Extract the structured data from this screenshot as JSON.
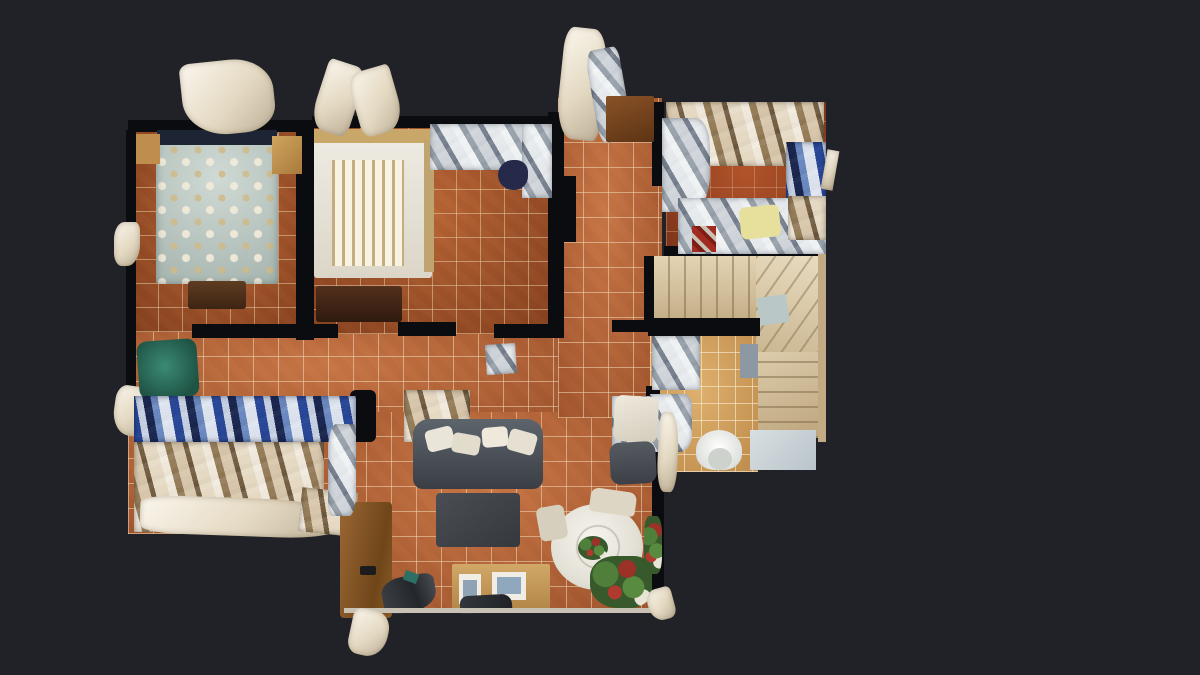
{
  "app": {
    "name": "3d-dollhouse-floorplan-viewer",
    "view_mode": "top-down dollhouse view",
    "content": "furnished apartment photogrammetry scan with scan-glitch artifacts"
  },
  "canvas": {
    "width": 1200,
    "height": 675,
    "background": "#212227"
  },
  "palette": {
    "background": "#212227",
    "wall": "#0b0c0f",
    "tile_terracotta": "#b46238",
    "tile_bedroom": "#a2542b",
    "tile_junk_room": "#9c4423",
    "tile_bathroom": "#d09d58",
    "stairs_beige": "#d7c39c",
    "sofa_gray": "#4c5157",
    "bed_floral": "#c3cfc9",
    "bed_white": "#e9e5da",
    "armchair_green": "#2c6f60",
    "dining_table_white": "#efede5",
    "wood": "#9a6633",
    "artifact_white": "#fbf7ee"
  },
  "scene": {
    "objects": [
      {
        "name": "floor-hallway",
        "cls": "tile",
        "x": 128,
        "y": 330,
        "w": 434,
        "h": 102
      },
      {
        "name": "floor-storage-corridor",
        "cls": "tile",
        "x": 128,
        "y": 420,
        "w": 220,
        "h": 114
      },
      {
        "name": "floor-living-room",
        "cls": "tile",
        "x": 341,
        "y": 412,
        "w": 320,
        "h": 200
      },
      {
        "name": "floor-corridor-top",
        "cls": "tile",
        "x": 558,
        "y": 98,
        "w": 104,
        "h": 320
      },
      {
        "name": "floor-bedroom-1",
        "cls": "tile-dark",
        "x": 134,
        "y": 130,
        "w": 176,
        "h": 202
      },
      {
        "name": "floor-bedroom-2",
        "cls": "tile-dark",
        "x": 312,
        "y": 126,
        "w": 240,
        "h": 208
      },
      {
        "name": "floor-junk-room",
        "cls": "tile-red",
        "x": 666,
        "y": 102,
        "w": 160,
        "h": 152
      },
      {
        "name": "floor-bathroom",
        "cls": "tile-light",
        "x": 650,
        "y": 334,
        "w": 108,
        "h": 138
      },
      {
        "name": "stairs-upper-flight",
        "cls": "steps-v",
        "x": 652,
        "y": 256,
        "w": 110,
        "h": 64
      },
      {
        "name": "stairs-winder",
        "cls": "steps-diag",
        "x": 756,
        "y": 256,
        "w": 66,
        "h": 104
      },
      {
        "name": "stairs-blue-patch",
        "x": 758,
        "y": 296,
        "w": 30,
        "h": 28,
        "bg": "#b9c8c6",
        "rot": -8
      },
      {
        "name": "stairs-lower-flight",
        "cls": "steps-h",
        "x": 758,
        "y": 352,
        "w": 64,
        "h": 86
      },
      {
        "name": "stairs-landing",
        "x": 750,
        "y": 430,
        "w": 66,
        "h": 40,
        "bg": "linear-gradient(135deg,#d8dfe2,#b9c4ca)"
      },
      {
        "name": "wall-bedroom1-left",
        "cls": "wall",
        "x": 126,
        "y": 130,
        "w": 10,
        "h": 294
      },
      {
        "name": "wall-bedroom1-top",
        "cls": "wall",
        "x": 128,
        "y": 120,
        "w": 184,
        "h": 12
      },
      {
        "name": "wall-bedroom-divider",
        "cls": "wall",
        "x": 296,
        "y": 126,
        "w": 18,
        "h": 214
      },
      {
        "name": "wall-bedroom2-top",
        "cls": "wall",
        "x": 312,
        "y": 116,
        "w": 240,
        "h": 12
      },
      {
        "name": "wall-bedroom2-right",
        "cls": "wall",
        "x": 548,
        "y": 112,
        "w": 16,
        "h": 222
      },
      {
        "name": "wall-hall-top-a",
        "cls": "wall",
        "x": 192,
        "y": 324,
        "w": 146,
        "h": 14
      },
      {
        "name": "wall-hall-top-b",
        "cls": "wall",
        "x": 398,
        "y": 322,
        "w": 58,
        "h": 14
      },
      {
        "name": "wall-hall-top-c",
        "cls": "wall",
        "x": 494,
        "y": 324,
        "w": 70,
        "h": 14
      },
      {
        "name": "wall-hall-top-d",
        "cls": "wall",
        "x": 612,
        "y": 320,
        "w": 52,
        "h": 12
      },
      {
        "name": "wall-stairs-hall-divider",
        "cls": "wall",
        "x": 648,
        "y": 318,
        "w": 112,
        "h": 18
      },
      {
        "name": "wall-junkroom-left",
        "cls": "wall",
        "x": 652,
        "y": 102,
        "w": 12,
        "h": 84
      },
      {
        "name": "wall-junkroom-bottom",
        "cls": "wall",
        "x": 664,
        "y": 246,
        "w": 158,
        "h": 10
      },
      {
        "name": "wall-stairs-left",
        "cls": "wall",
        "x": 644,
        "y": 256,
        "w": 10,
        "h": 64
      },
      {
        "name": "wall-bathroom-left",
        "cls": "wall",
        "x": 646,
        "y": 386,
        "w": 14,
        "h": 88
      },
      {
        "name": "wall-livingroom-right",
        "cls": "wall",
        "x": 652,
        "y": 412,
        "w": 12,
        "h": 200
      },
      {
        "name": "wall-corridor-stub",
        "cls": "wall",
        "x": 558,
        "y": 176,
        "w": 18,
        "h": 66
      },
      {
        "name": "wall-storage-block",
        "cls": "wall",
        "x": 350,
        "y": 390,
        "w": 26,
        "h": 52,
        "br": "6px"
      },
      {
        "name": "bed-floral",
        "cls": "floral",
        "x": 156,
        "y": 132,
        "w": 122,
        "h": 152,
        "br": "3px"
      },
      {
        "name": "bed-floral-headboard",
        "x": 157,
        "y": 130,
        "w": 120,
        "h": 15,
        "bg": "#1d2434"
      },
      {
        "name": "bed-foot-bench",
        "x": 188,
        "y": 281,
        "w": 58,
        "h": 28,
        "bg": "linear-gradient(180deg,#5f3c22,#3c2414)",
        "br": "3px"
      },
      {
        "name": "nightstand-left",
        "x": 136,
        "y": 134,
        "w": 24,
        "h": 30,
        "bg": "#bf8e4c"
      },
      {
        "name": "nightstand-right",
        "x": 272,
        "y": 136,
        "w": 30,
        "h": 38,
        "bg": "linear-gradient(135deg,#d0a55e,#a87a3c)"
      },
      {
        "name": "scan-artifact-headboard",
        "cls": "glitch",
        "x": 182,
        "y": 60,
        "w": 92,
        "h": 74,
        "br": "12% 45% 35% 50%",
        "rot": -6
      },
      {
        "name": "scan-artifact-left-upper",
        "cls": "glitch",
        "x": 114,
        "y": 222,
        "w": 26,
        "h": 44,
        "br": "40% 20% 50% 30%"
      },
      {
        "name": "scan-artifact-left-lower",
        "cls": "glitch",
        "x": 114,
        "y": 386,
        "w": 36,
        "h": 50,
        "br": "30% 45% 25% 50%",
        "rot": 8
      },
      {
        "name": "bed-white",
        "x": 314,
        "y": 130,
        "w": 118,
        "h": 148,
        "bg": "linear-gradient(180deg,#efece4,#dcd6c8)",
        "br": "3px"
      },
      {
        "name": "bed-white-headboard",
        "x": 314,
        "y": 129,
        "w": 118,
        "h": 14,
        "bg": "#c8a768"
      },
      {
        "name": "bed-white-blanket",
        "cls": "slats",
        "x": 332,
        "y": 160,
        "w": 72,
        "h": 106
      },
      {
        "name": "bed-white-side-rail",
        "x": 424,
        "y": 140,
        "w": 10,
        "h": 132,
        "bg": "#c0a470"
      },
      {
        "name": "dresser-dark",
        "x": 316,
        "y": 286,
        "w": 86,
        "h": 36,
        "bg": "linear-gradient(180deg,#53301d,#2e1a0e)",
        "br": "3px"
      },
      {
        "name": "wardrobe-mirror-top",
        "cls": "clutter-cool",
        "x": 430,
        "y": 124,
        "w": 120,
        "h": 46
      },
      {
        "name": "wardrobe-mirror-right",
        "cls": "clutter-cool",
        "x": 522,
        "y": 124,
        "w": 30,
        "h": 74
      },
      {
        "name": "chair-navy",
        "x": 498,
        "y": 160,
        "w": 30,
        "h": 30,
        "bg": "#262a4a",
        "br": "50% 40% 45% 50%"
      },
      {
        "name": "door-artifact-1",
        "cls": "glitch",
        "x": 318,
        "y": 62,
        "w": 40,
        "h": 72,
        "rot": 18,
        "br": "10% 30% 20% 40%"
      },
      {
        "name": "door-artifact-2",
        "cls": "glitch",
        "x": 354,
        "y": 68,
        "w": 44,
        "h": 66,
        "rot": -16,
        "br": "30% 10% 45% 20%"
      },
      {
        "name": "door-artifact-3",
        "cls": "glitch",
        "x": 560,
        "y": 28,
        "w": 44,
        "h": 112,
        "rot": 6,
        "br": "20% 35% 15% 40%"
      },
      {
        "name": "door-artifact-4",
        "cls": "clutter-cool",
        "x": 592,
        "y": 48,
        "w": 34,
        "h": 94,
        "rot": -10,
        "br": "25% 15% 40% 20%"
      },
      {
        "name": "cabinet-wood",
        "x": 606,
        "y": 96,
        "w": 48,
        "h": 46,
        "bg": "linear-gradient(160deg,#8a5226,#5c3414)",
        "br": "2px"
      },
      {
        "name": "clutter-junk-top",
        "cls": "clutter-warm",
        "x": 666,
        "y": 102,
        "w": 158,
        "h": 64
      },
      {
        "name": "clutter-junk-left",
        "cls": "clutter-cool",
        "x": 662,
        "y": 118,
        "w": 48,
        "h": 94,
        "br": "0 30% 40% 0"
      },
      {
        "name": "clutter-junk-right-blue",
        "cls": "clutter-blue",
        "x": 786,
        "y": 142,
        "w": 40,
        "h": 90
      },
      {
        "name": "clutter-junk-bottom",
        "cls": "clutter-cool",
        "x": 678,
        "y": 198,
        "w": 148,
        "h": 56
      },
      {
        "name": "cushion-yellow",
        "x": 740,
        "y": 206,
        "w": 40,
        "h": 32,
        "bg": "#e6e09c",
        "br": "6px",
        "rot": -6
      },
      {
        "name": "clutter-junk-red",
        "x": 692,
        "y": 226,
        "w": 24,
        "h": 26,
        "bg": "repeating-linear-gradient(45deg,#a32c22 0 6px,#7c1e16 6px 10px,#c8c2b2 10px 14px)"
      },
      {
        "name": "clutter-junk-tan-corner",
        "cls": "clutter-warm",
        "x": 788,
        "y": 196,
        "w": 38,
        "h": 44
      },
      {
        "name": "glitch-junkroom-right",
        "cls": "glitch",
        "x": 824,
        "y": 150,
        "w": 12,
        "h": 40,
        "rot": 10
      },
      {
        "name": "bathroom-fixture-glitch",
        "cls": "clutter-cool",
        "x": 652,
        "y": 336,
        "w": 48,
        "h": 54
      },
      {
        "name": "sink-glitch",
        "cls": "clutter-cool",
        "x": 650,
        "y": 394,
        "w": 42,
        "h": 58,
        "br": "0 20% 30% 0"
      },
      {
        "name": "toilet-bowl",
        "x": 696,
        "y": 430,
        "w": 46,
        "h": 40,
        "bg": "radial-gradient(circle at 50% 45%,#ffffff,#dfe2de 70%,#c6cac4)",
        "br": "50% 50% 40% 40%"
      },
      {
        "name": "toilet-seat-opening",
        "x": 708,
        "y": 448,
        "w": 24,
        "h": 22,
        "bg": "#cdd2cc",
        "br": "50%"
      },
      {
        "name": "mat-blue-gray",
        "x": 740,
        "y": 344,
        "w": 18,
        "h": 34,
        "bg": "#8d99a2"
      },
      {
        "name": "mat-reflective",
        "cls": "clutter-cool",
        "x": 486,
        "y": 344,
        "w": 30,
        "h": 30,
        "rot": -4
      },
      {
        "name": "clutter-hall-right",
        "cls": "clutter-cool",
        "x": 612,
        "y": 396,
        "w": 38,
        "h": 78
      },
      {
        "name": "armchair-green",
        "x": 138,
        "y": 340,
        "w": 60,
        "h": 58,
        "bg": "radial-gradient(circle at 45% 45%,#3b8a74,#1f5445 75%)",
        "br": "10px",
        "rot": -4
      },
      {
        "name": "shelf-blue-bins",
        "cls": "clutter-blue",
        "x": 134,
        "y": 396,
        "w": 222,
        "h": 46
      },
      {
        "name": "clutter-bags-right",
        "cls": "clutter-warm",
        "x": 404,
        "y": 390,
        "w": 66,
        "h": 52
      },
      {
        "name": "shelf-lower-clutter",
        "cls": "clutter-warm",
        "x": 134,
        "y": 442,
        "w": 190,
        "h": 90
      },
      {
        "name": "glitch-storage-bottom",
        "cls": "glitch",
        "x": 140,
        "y": 498,
        "w": 200,
        "h": 38,
        "br": "20% 40% 30% 20%",
        "rot": 2
      },
      {
        "name": "glitch-storage-bottom-right",
        "cls": "clutter-warm",
        "x": 300,
        "y": 490,
        "w": 56,
        "h": 44,
        "rot": 6
      },
      {
        "name": "sofa",
        "x": 413,
        "y": 419,
        "w": 130,
        "h": 70,
        "bg": "linear-gradient(180deg,#5d646c,#454a51 70%,#3a3e44)",
        "br": "16px 16px 10px 10px"
      },
      {
        "name": "sofa-cushion-1",
        "x": 426,
        "y": 428,
        "w": 28,
        "h": 22,
        "bg": "#eae5d9",
        "br": "5px",
        "rot": -14
      },
      {
        "name": "sofa-cushion-2",
        "x": 452,
        "y": 434,
        "w": 28,
        "h": 20,
        "bg": "#e2dccd",
        "br": "5px",
        "rot": 10
      },
      {
        "name": "sofa-cushion-3",
        "x": 482,
        "y": 427,
        "w": 26,
        "h": 20,
        "bg": "#efe9dc",
        "br": "5px",
        "rot": -5
      },
      {
        "name": "sofa-cushion-4",
        "x": 508,
        "y": 431,
        "w": 28,
        "h": 22,
        "bg": "#e6e0d2",
        "br": "5px",
        "rot": 16
      },
      {
        "name": "coffee-table",
        "x": 436,
        "y": 493,
        "w": 84,
        "h": 54,
        "bg": "linear-gradient(145deg,#4a4e54,#35383d)",
        "br": "4px"
      },
      {
        "name": "dining-table",
        "x": 551,
        "y": 504,
        "w": 92,
        "h": 86,
        "bg": "radial-gradient(circle at 45% 40%,#f6f4ee,#e3e0d6 60%,#c9c6ba)",
        "br": "50%"
      },
      {
        "name": "dining-table-inner-ring",
        "x": 572,
        "y": 522,
        "w": 52,
        "h": 50,
        "bg": "radial-gradient(circle, rgba(0,0,0,0) 55%, rgba(150,145,130,.55) 58%, rgba(0,0,0,0) 63%)",
        "br": "50%"
      },
      {
        "name": "centerpiece-plant",
        "cls": "plant",
        "x": 578,
        "y": 536,
        "w": 30,
        "h": 24,
        "br": "50%"
      },
      {
        "name": "dining-chair-top",
        "x": 590,
        "y": 490,
        "w": 46,
        "h": 24,
        "bg": "#ddd6c4",
        "br": "8px 8px 4px 4px",
        "rot": 8
      },
      {
        "name": "dining-chair-left",
        "x": 538,
        "y": 506,
        "w": 28,
        "h": 34,
        "bg": "#d6cfbd",
        "br": "6px",
        "rot": -10
      },
      {
        "name": "chair-white-corner",
        "x": 614,
        "y": 396,
        "w": 44,
        "h": 46,
        "bg": "linear-gradient(160deg,#efeadd,#d2ccbc)",
        "br": "8px",
        "rot": 4
      },
      {
        "name": "armchair-dark",
        "x": 610,
        "y": 442,
        "w": 46,
        "h": 42,
        "bg": "linear-gradient(180deg,#565b61,#3c4046)",
        "br": "10px",
        "rot": -3
      },
      {
        "name": "plant-arrangement",
        "cls": "plant",
        "x": 590,
        "y": 556,
        "w": 62,
        "h": 52,
        "br": "40% 30% 35% 45%"
      },
      {
        "name": "plant-right-edge",
        "cls": "plant",
        "x": 644,
        "y": 516,
        "w": 18,
        "h": 58,
        "br": "30%"
      },
      {
        "name": "sideboard",
        "x": 452,
        "y": 564,
        "w": 98,
        "h": 48,
        "bg": "linear-gradient(180deg,#d2a868,#b08546)",
        "br": "2px"
      },
      {
        "name": "picture-frame-1",
        "x": 459,
        "y": 574,
        "w": 22,
        "h": 30,
        "bg": "#f0ede4"
      },
      {
        "name": "picture-photo-1",
        "x": 463,
        "y": 580,
        "w": 14,
        "h": 18,
        "bg": "#8fa3b5"
      },
      {
        "name": "picture-frame-2",
        "x": 492,
        "y": 572,
        "w": 34,
        "h": 28,
        "bg": "#f0ede4"
      },
      {
        "name": "picture-photo-2",
        "x": 497,
        "y": 577,
        "w": 24,
        "h": 17,
        "bg": "#90a8be"
      },
      {
        "name": "bag-dark",
        "x": 460,
        "y": 595,
        "w": 52,
        "h": 18,
        "bg": "linear-gradient(100deg,#34373c,#1f2226)",
        "br": "8px 10px 4px 4px",
        "rot": -3
      },
      {
        "name": "desk-wood",
        "x": 340,
        "y": 502,
        "w": 52,
        "h": 116,
        "bg": "linear-gradient(100deg,#9a6633,#6f4619 70%,#8a5a28)",
        "br": "4px"
      },
      {
        "name": "desk-handle",
        "x": 360,
        "y": 566,
        "w": 16,
        "h": 9,
        "bg": "#1c1c1e",
        "br": "2px"
      },
      {
        "name": "scan-noise-dark",
        "x": 382,
        "y": 576,
        "w": 54,
        "h": 36,
        "bg": "linear-gradient(80deg,#3d4046,#23262b 60%,#4a4e54)",
        "br": "40% 20% 50% 30%",
        "rot": -10
      },
      {
        "name": "scan-noise-teal",
        "x": 404,
        "y": 572,
        "w": 14,
        "h": 10,
        "bg": "#2e6f66",
        "rot": 20
      },
      {
        "name": "glitch-living-left",
        "cls": "clutter-cool",
        "x": 328,
        "y": 424,
        "w": 28,
        "h": 92,
        "br": "30% 10% 25% 15%"
      },
      {
        "name": "curtain-glitch-right",
        "cls": "glitch",
        "x": 658,
        "y": 412,
        "w": 20,
        "h": 80,
        "br": "20% 50% 30% 40%",
        "rot": 3
      },
      {
        "name": "wall-livingroom-bottom-edge",
        "x": 344,
        "y": 608,
        "w": 316,
        "h": 5,
        "bg": "#c9c2b4"
      },
      {
        "name": "wall-stairs-right-edge",
        "x": 818,
        "y": 254,
        "w": 8,
        "h": 188,
        "bg": "#c2ab84"
      },
      {
        "name": "glitch-bottom-protrusion",
        "cls": "glitch",
        "x": 350,
        "y": 610,
        "w": 38,
        "h": 46,
        "rot": 12,
        "br": "20% 40% 50% 30%"
      },
      {
        "name": "glitch-bottom-right",
        "cls": "glitch",
        "x": 648,
        "y": 588,
        "w": 26,
        "h": 32,
        "rot": -15,
        "br": "40% 20% 30% 50%"
      }
    ]
  }
}
